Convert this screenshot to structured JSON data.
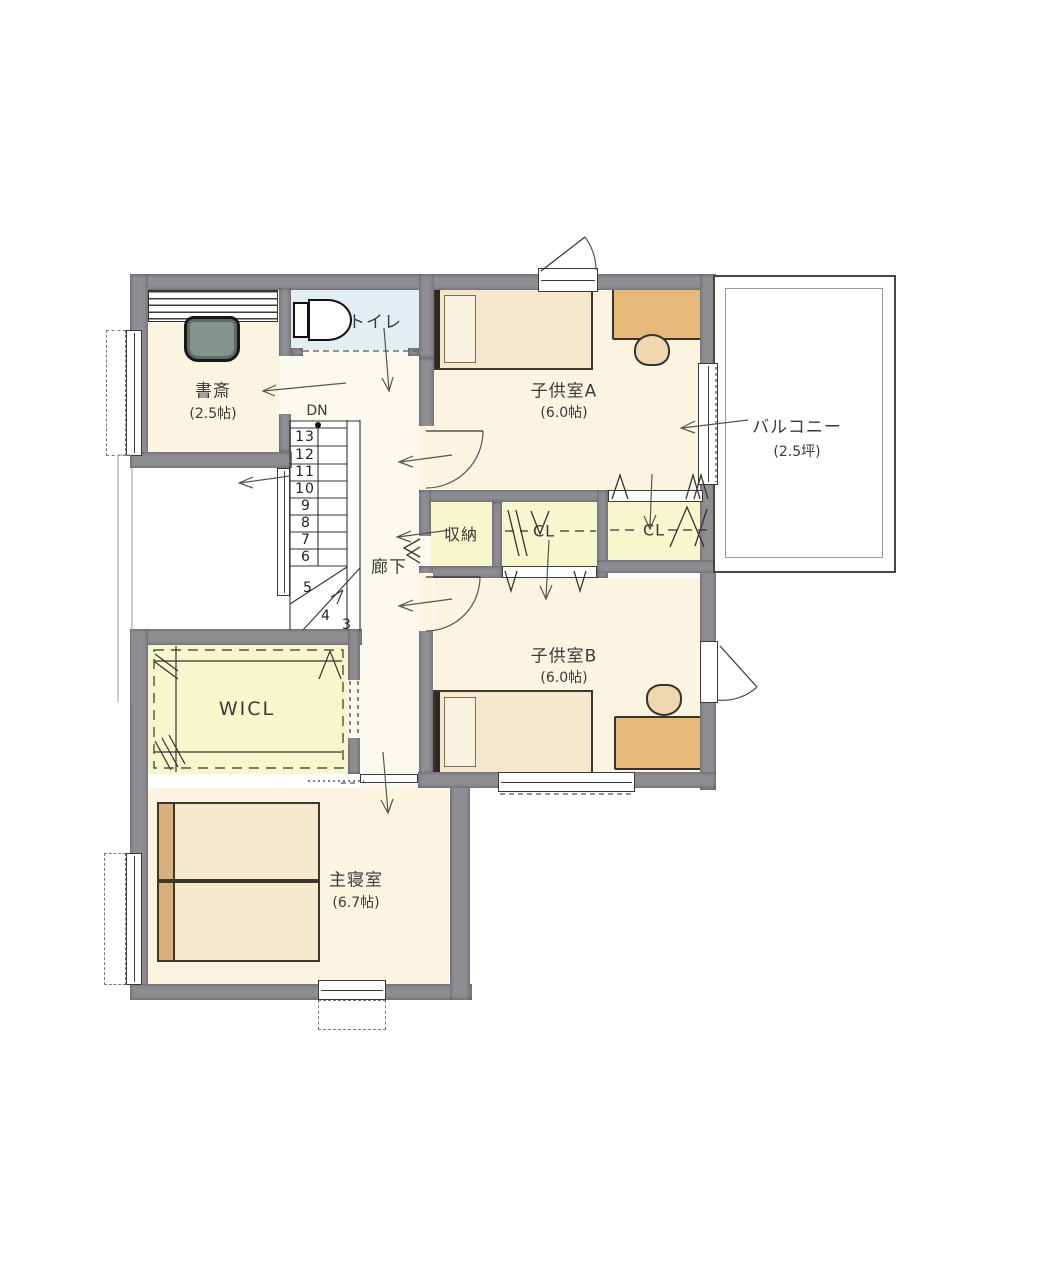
{
  "rooms": {
    "study": {
      "name": "書斎",
      "area": "(2.5帖)"
    },
    "toilet": {
      "name": "トイレ"
    },
    "kids_a": {
      "name": "子供室A",
      "area": "(6.0帖)"
    },
    "balcony": {
      "name": "バルコニー",
      "area": "(2.5坪)"
    },
    "storage": {
      "name": "収納"
    },
    "closet_a": {
      "name": "CL"
    },
    "closet_b": {
      "name": "CL"
    },
    "hallway": {
      "name": "廊下"
    },
    "kids_b": {
      "name": "子供室B",
      "area": "(6.0帖)"
    },
    "wicl": {
      "name": "WICL"
    },
    "master": {
      "name": "主寝室",
      "area": "(6.7帖)"
    }
  },
  "stairs": {
    "direction": "DN",
    "steps": [
      "13",
      "12",
      "11",
      "10",
      "9",
      "8",
      "7",
      "6",
      "5",
      "4",
      "3"
    ]
  },
  "colors": {
    "wall": "#8e8e93",
    "wall_edge": "#6a6a70",
    "floor": "#fbf4e0",
    "hall": "#fcf9ef",
    "closet": "#f6f7cd",
    "toilet_floor": "#e2eef1",
    "bed": "#f5e8cc",
    "bed_outline": "#3e372c",
    "headboard": "#d9b07c",
    "desk": "#e6b87a",
    "chair": "#eed6ae",
    "study_chair": "#84958e",
    "line": "#3a3a3a"
  }
}
